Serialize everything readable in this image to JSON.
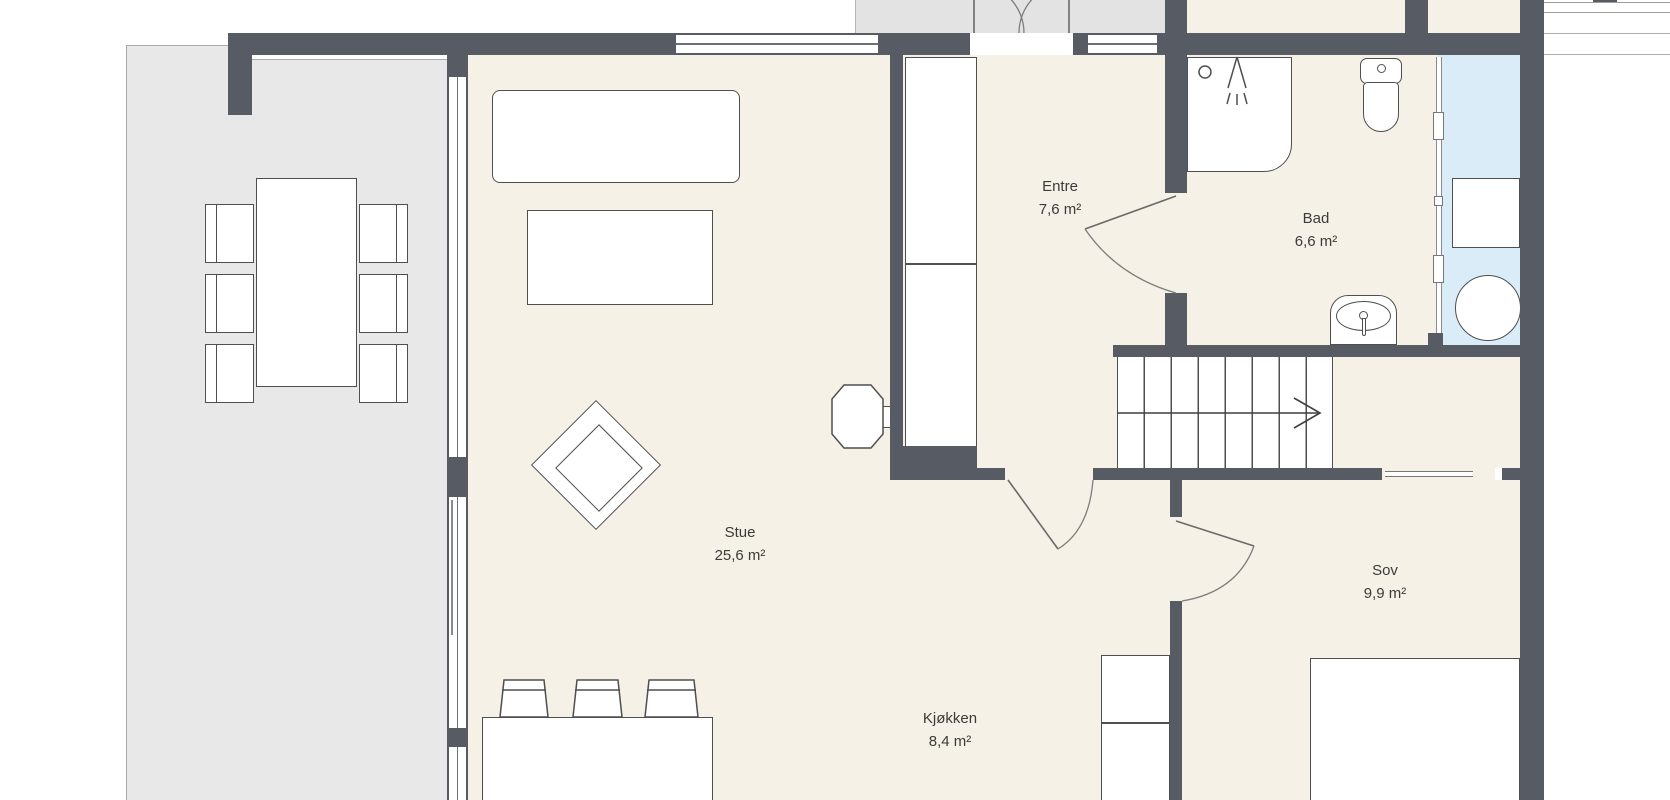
{
  "floorplan": {
    "title": "Apartment floor plan",
    "rooms": [
      {
        "name": "Stue",
        "area": "25,6 m²"
      },
      {
        "name": "Entre",
        "area": "7,6 m²"
      },
      {
        "name": "Bad",
        "area": "6,6 m²"
      },
      {
        "name": "Sov",
        "area": "9,9 m²"
      },
      {
        "name": "Kjøkken",
        "area": "8,4 m²"
      }
    ],
    "colors": {
      "wall": "#565b64",
      "floor": "#f6f1e7",
      "terrace": "#e8e8e8",
      "porch": "#e3e3e3",
      "wet_zone": "#d9ecf7",
      "furniture_outline": "#4f4f4f",
      "text": "#3b3b3b"
    },
    "elements": [
      "sofa",
      "coffee-table",
      "armchair",
      "desk-chair",
      "dining-table",
      "dining-chair",
      "kitchen-island",
      "bar-stool",
      "kitchen-cabinet",
      "wardrobe",
      "bed",
      "staircase",
      "shower",
      "toilet",
      "bathroom-sink",
      "washing-machine",
      "glass-partition",
      "laundry-basket"
    ]
  }
}
